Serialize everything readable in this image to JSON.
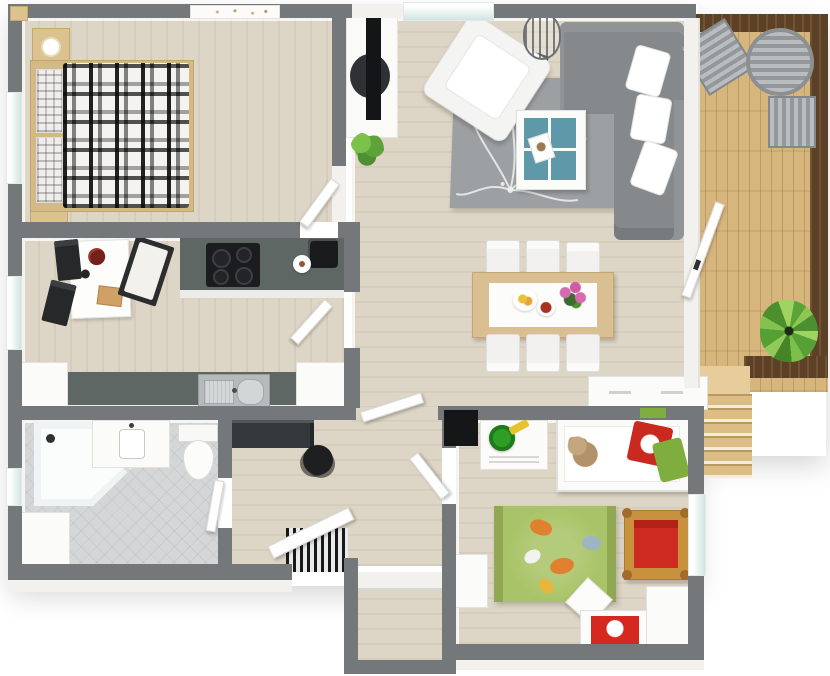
{
  "meta": {
    "type": "3d-floor-plan",
    "description": "Top-down 3D rendered floor plan of a two-bedroom apartment with wooden deck and stairs"
  },
  "colors": {
    "wall": "#75787b",
    "wallFace": "#f2f1ee",
    "floor": "#ddd5c5",
    "tile": "#d5d6d8",
    "counter": "#5e6763",
    "glass": "#cfe5e2",
    "white": "#fbfbf9",
    "dark": "#1a1c1e",
    "console": "#35383b",
    "sofa": "#85898c",
    "rug": "#9da0a2",
    "armchair": "#f4f4f2",
    "tableWood": "#d9bf92",
    "teal": "#5f99a9",
    "kidsRug": "#a9c468",
    "kidsRugEdge": "#8fa851",
    "cribRed": "#cd2b20",
    "cribWood": "#c8913e",
    "pillowRed": "#c9291f",
    "pillowGreen": "#7fae3f",
    "plantGreen": "#5da23a",
    "deckWood": "#d7b67e",
    "deckBorder": "#5d4126",
    "stairWood": "#ddbd86",
    "toyGreen": "#2f9e27",
    "shovelYellow": "#e7c32e",
    "matRed": "#d5281f",
    "steel": "#bcc0c1"
  },
  "rooms": [
    {
      "id": "bedroom",
      "name": "master bedroom",
      "furniture": [
        "double bed with plaid blanket",
        "nightstand with lamp",
        "second nightstand",
        "wall art"
      ]
    },
    {
      "id": "kitchen",
      "name": "kitchen",
      "furniture": [
        "breakfast table",
        "two black chairs",
        "bench seat",
        "cooktop counter",
        "coffee machine",
        "sink counter",
        "tall white cabinets"
      ]
    },
    {
      "id": "bathroom",
      "name": "bathroom",
      "furniture": [
        "corner shower",
        "vanity with sink",
        "toilet",
        "storage cabinet"
      ]
    },
    {
      "id": "hallway",
      "name": "hallway / entry",
      "furniture": [
        "dark console",
        "round stool",
        "striped doormat",
        "entrance door"
      ]
    },
    {
      "id": "closet",
      "name": "storage closet",
      "furniture": [
        "shelf"
      ]
    },
    {
      "id": "living",
      "name": "living room",
      "furniture": [
        "gray corner sofa",
        "white cushions",
        "white armchair",
        "coffee table with teal top",
        "wire floor lamp",
        "tv divider wall",
        "potted plant",
        "floral rug"
      ]
    },
    {
      "id": "dining",
      "name": "dining area",
      "furniture": [
        "wooden dining table",
        "six white chairs",
        "fruit plate",
        "flowers",
        "white sideboard"
      ]
    },
    {
      "id": "kids",
      "name": "kids bedroom",
      "furniture": [
        "single bed",
        "teddy bear",
        "red pillow",
        "green pillow",
        "dresser with toy bucket",
        "green play rug",
        "wooden crib with red mattress",
        "desk with red mat",
        "white chair",
        "wardrobe"
      ]
    },
    {
      "id": "deck",
      "name": "deck / balcony",
      "furniture": [
        "two slatted lounge chairs",
        "round slatted table",
        "fern plant",
        "wooden stairs"
      ]
    }
  ]
}
